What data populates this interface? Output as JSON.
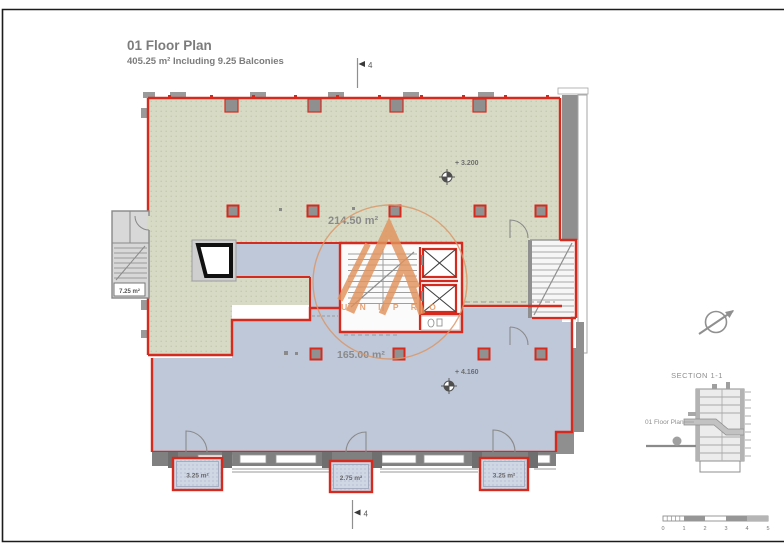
{
  "sheet": {
    "title": "01 Floor Plan",
    "subtitle": "405.25 m² Including 9.25 Balconies"
  },
  "plan": {
    "upper_area_label": "214.50 m²",
    "lower_area_label": "165.00 m²",
    "annex_area_label": "7.25 m²",
    "upper_elevation": "+ 3.200",
    "lower_elevation": "+ 4.160",
    "section_cut_label": "4",
    "balconies": [
      {
        "label": "3.25 m²"
      },
      {
        "label": "2.75 m²"
      },
      {
        "label": "3.25 m²"
      }
    ]
  },
  "side_panel": {
    "section_title": "SECTION 1-1",
    "section_floor_label": "01 Floor Plan",
    "scale_ticks": [
      "0",
      "1",
      "2",
      "3",
      "4",
      "5"
    ]
  },
  "watermark": {
    "text": "U N I P R O"
  },
  "colors": {
    "wall_red": "#d62a1e",
    "zone_green": "#d7dbc6",
    "zone_blue": "#bfc8d8",
    "wall_gray": "#7e7e7e",
    "watermark_orange": "#e2935c",
    "text_gray": "#7d7d7d"
  }
}
